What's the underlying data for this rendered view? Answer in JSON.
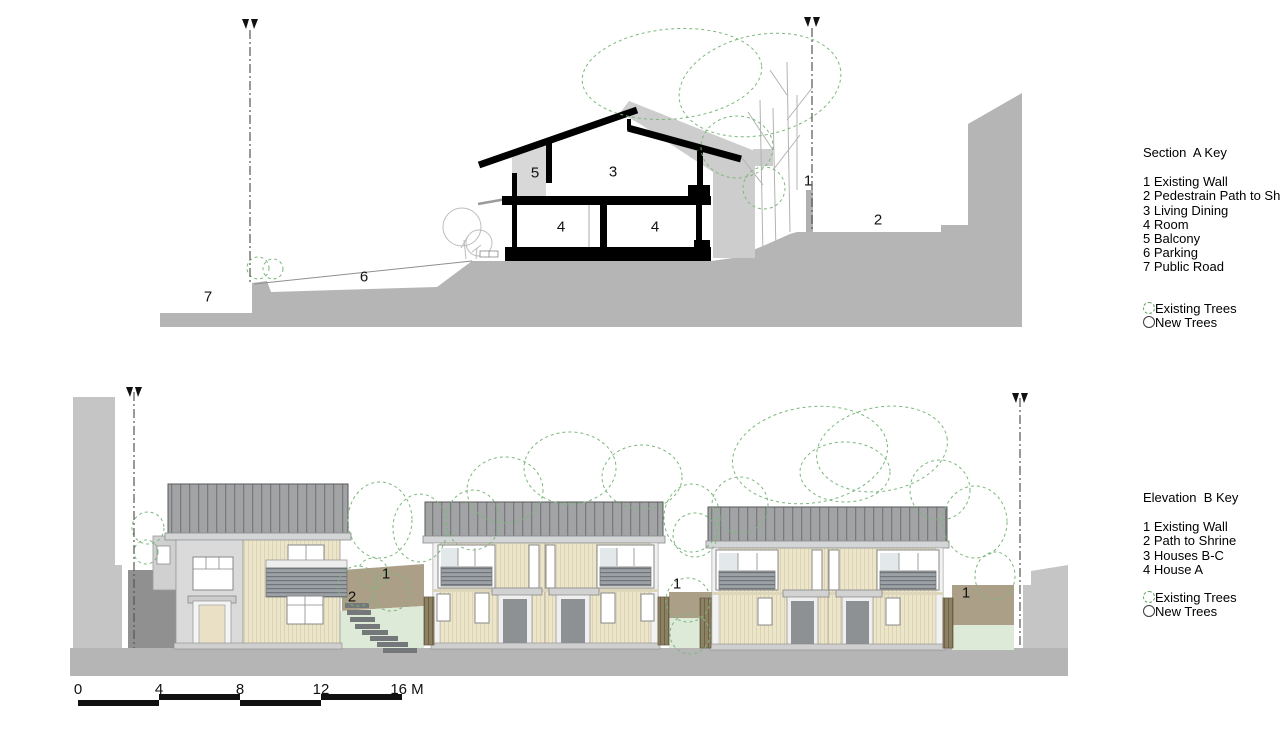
{
  "section_key": {
    "title": "Section  A Key",
    "items": [
      "1 Existing Wall",
      "2 Pedestrain Path to Shrine",
      "3 Living Dining",
      "4 Room",
      "5 Balcony",
      "6 Parking",
      "7 Public Road"
    ],
    "legend": [
      {
        "icon": "existing-tree-icon",
        "label": "Existing Trees"
      },
      {
        "icon": "new-tree-icon",
        "label": "New Trees"
      }
    ]
  },
  "elevation_key": {
    "title": "Elevation  B Key",
    "items": [
      "1 Existing Wall",
      "2 Path to Shrine",
      "3 Houses B-C",
      "4 House A"
    ],
    "legend": [
      {
        "icon": "existing-tree-icon",
        "label": "Existing Trees"
      },
      {
        "icon": "new-tree-icon",
        "label": "New Trees"
      }
    ]
  },
  "annotations": {
    "section": [
      {
        "name": "section-label-7-public-road",
        "text": "7",
        "x": 208,
        "y": 297
      },
      {
        "name": "section-label-6-parking",
        "text": "6",
        "x": 364,
        "y": 277
      },
      {
        "name": "section-label-5-balcony",
        "text": "5",
        "x": 535,
        "y": 173
      },
      {
        "name": "section-label-3-living-dining",
        "text": "3",
        "x": 613,
        "y": 172
      },
      {
        "name": "section-label-4-room-left",
        "text": "4",
        "x": 561,
        "y": 227
      },
      {
        "name": "section-label-4-room-right",
        "text": "4",
        "x": 655,
        "y": 227
      },
      {
        "name": "section-label-1-existing-wall",
        "text": "1",
        "x": 808,
        "y": 181
      },
      {
        "name": "section-label-2-pedestrian-path",
        "text": "2",
        "x": 878,
        "y": 220
      }
    ],
    "elevation": [
      {
        "name": "elevation-label-1-existing-wall-a",
        "text": "1",
        "x": 386,
        "y": 574
      },
      {
        "name": "elevation-label-2-path-to-shrine",
        "text": "2",
        "x": 352,
        "y": 597
      },
      {
        "name": "elevation-label-1-existing-wall-b",
        "text": "1",
        "x": 677,
        "y": 584
      },
      {
        "name": "elevation-label-1-existing-wall-c",
        "text": "1",
        "x": 966,
        "y": 593
      }
    ]
  },
  "scale_bar": {
    "unit_suffix": "M",
    "ticks": [
      {
        "label": "0",
        "x": 78
      },
      {
        "label": "4",
        "x": 159
      },
      {
        "label": "8",
        "x": 240
      },
      {
        "label": "12",
        "x": 321
      },
      {
        "label": "16 M",
        "x": 407
      }
    ]
  },
  "colors": {
    "ground_gray": "#b5b5b5",
    "silhouette_gray": "#c5c5c5",
    "roof_gray": "#a1a3a5",
    "siding_cream": "#ece5ca",
    "existing_wall_brown": "#ac9f88",
    "ground_green": "#dcead7",
    "tree_green": "#7cb77c",
    "cut_black": "#000000"
  }
}
